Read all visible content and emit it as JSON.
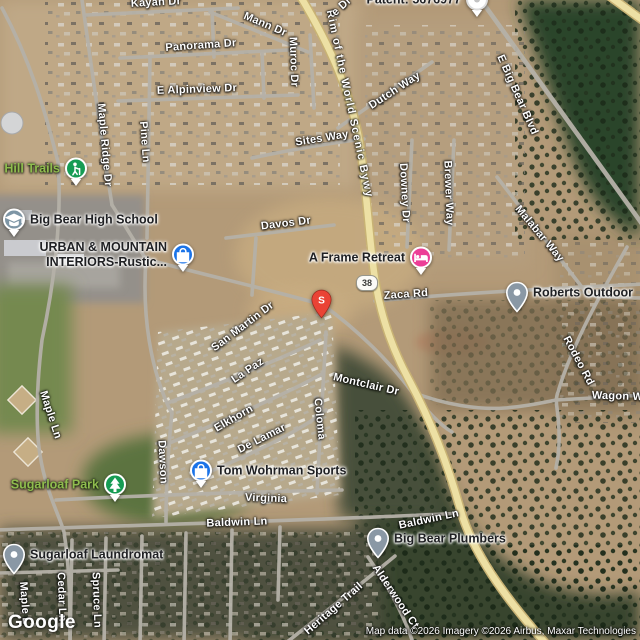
{
  "map": {
    "type": "satellite",
    "google_logo": "Google",
    "attribution": "Map data ©2026 Imagery ©2026 Airbus, Maxar Technologies",
    "route_shield": {
      "text": "38",
      "x": 366,
      "y": 282
    },
    "pin": {
      "label": "S",
      "x": 321,
      "y": 318,
      "color": "#EA4335"
    },
    "colors": {
      "shopping_blue": "#1A73E8",
      "lodging_pink": "#EC3E97",
      "park_green": "#169C54",
      "school_gray": "#7E96A6",
      "generic_pin_gray": "#8A98A5",
      "white_poi": "#FFFFFF",
      "park_label_green": "#8FBC4E",
      "highway_yellow": "#EDE0A4"
    },
    "street_labels": [
      {
        "text": "Kayan Dr",
        "x": 156,
        "y": 3,
        "r": -3
      },
      {
        "text": "Mann Dr",
        "x": 265,
        "y": 25,
        "r": 23
      },
      {
        "text": "Panorama Dr",
        "x": 201,
        "y": 46,
        "r": -4
      },
      {
        "text": "E Alpinview Dr",
        "x": 197,
        "y": 90,
        "r": -2
      },
      {
        "text": "Muroc Dr",
        "x": 293,
        "y": 62,
        "r": 88
      },
      {
        "text": "Rim of the World Scenic Bywy",
        "x": 349,
        "y": 104,
        "r": 78,
        "long": true
      },
      {
        "text": "Dutch Way",
        "x": 395,
        "y": 91,
        "r": -33
      },
      {
        "text": "Sites Way",
        "x": 322,
        "y": 139,
        "r": -9
      },
      {
        "text": "Downey Dr",
        "x": 404,
        "y": 193,
        "r": 87
      },
      {
        "text": "Brewer Way",
        "x": 448,
        "y": 193,
        "r": 88
      },
      {
        "text": "E Big Bear Blvd",
        "x": 517,
        "y": 95,
        "r": 66
      },
      {
        "text": "Malabar Way",
        "x": 539,
        "y": 234,
        "r": 50
      },
      {
        "text": "Maple Ridge Dr",
        "x": 104,
        "y": 145,
        "r": 85
      },
      {
        "text": "Pine Ln",
        "x": 144,
        "y": 142,
        "r": 86
      },
      {
        "text": "Davos Dr",
        "x": 286,
        "y": 224,
        "r": -7
      },
      {
        "text": "Zaca Rd",
        "x": 406,
        "y": 295,
        "r": -4
      },
      {
        "text": "San Martin Dr",
        "x": 243,
        "y": 327,
        "r": -37
      },
      {
        "text": "La Paz",
        "x": 248,
        "y": 371,
        "r": -34
      },
      {
        "text": "Montclair Dr",
        "x": 366,
        "y": 385,
        "r": 13
      },
      {
        "text": "Elkhorn",
        "x": 234,
        "y": 419,
        "r": -30
      },
      {
        "text": "De Lamar",
        "x": 262,
        "y": 439,
        "r": -27
      },
      {
        "text": "Coloma",
        "x": 319,
        "y": 419,
        "r": 84
      },
      {
        "text": "Dawson",
        "x": 162,
        "y": 462,
        "r": 87
      },
      {
        "text": "Maple Ln",
        "x": 50,
        "y": 415,
        "r": 72
      },
      {
        "text": "Rodeo Rd",
        "x": 578,
        "y": 361,
        "r": 62
      },
      {
        "text": "Wagon Wh",
        "x": 621,
        "y": 397,
        "r": 2
      },
      {
        "text": "Virginia",
        "x": 266,
        "y": 499,
        "r": 2
      },
      {
        "text": "Baldwin Ln",
        "x": 237,
        "y": 523,
        "r": -2
      },
      {
        "text": "Baldwin Ln",
        "x": 429,
        "y": 520,
        "r": -12
      },
      {
        "text": "Heritage Trail",
        "x": 334,
        "y": 609,
        "r": -41
      },
      {
        "text": "Alderwood Ct",
        "x": 395,
        "y": 597,
        "r": 56
      },
      {
        "text": "Maple L",
        "x": 24,
        "y": 603,
        "r": 86
      },
      {
        "text": "Cedar Ln",
        "x": 61,
        "y": 597,
        "r": 88
      },
      {
        "text": "Spruce Ln",
        "x": 96,
        "y": 600,
        "r": 88
      },
      {
        "text": "e Dr",
        "x": 342,
        "y": 7,
        "r": -42
      }
    ],
    "pois": [
      {
        "name": "Hill Trails",
        "lines": [
          "Hill Trails"
        ],
        "icon": "hiking",
        "shape": "circle",
        "color": "#169C54",
        "cx": 76,
        "cy": 168,
        "side": "left",
        "label_class": "green"
      },
      {
        "name": "Big Bear High School",
        "lines": [
          "Big Bear High School"
        ],
        "icon": "school",
        "shape": "circle",
        "color": "#7E96A6",
        "cx": 14,
        "cy": 219,
        "side": "right",
        "label_class": ""
      },
      {
        "name": "URBAN & MOUNTAIN INTERIORS-Rustic...",
        "lines": [
          "URBAN & MOUNTAIN",
          "INTERIORS-Rustic..."
        ],
        "icon": "shopping",
        "shape": "circle",
        "color": "#1A73E8",
        "cx": 183,
        "cy": 254,
        "side": "left",
        "label_class": ""
      },
      {
        "name": "A Frame Retreat",
        "lines": [
          "A Frame Retreat"
        ],
        "icon": "lodging",
        "shape": "circle",
        "color": "#EC3E97",
        "cx": 421,
        "cy": 257,
        "side": "left",
        "label_class": ""
      },
      {
        "name": "Roberts Outdoor",
        "lines": [
          "Roberts Outdoor"
        ],
        "icon": "place",
        "shape": "pin",
        "color": "#8A98A5",
        "cx": 517,
        "cy": 311,
        "side": "right",
        "label_class": ""
      },
      {
        "name": "Tom Wohrman Sports",
        "lines": [
          "Tom Wohrman Sports"
        ],
        "icon": "shopping",
        "shape": "circle",
        "color": "#1A73E8",
        "cx": 201,
        "cy": 470,
        "side": "right",
        "label_class": ""
      },
      {
        "name": "Sugarloaf Park",
        "lines": [
          "Sugarloaf Park"
        ],
        "icon": "park",
        "shape": "circle",
        "color": "#169C54",
        "cx": 115,
        "cy": 484,
        "side": "left",
        "label_class": "green"
      },
      {
        "name": "Big Bear Plumbers",
        "lines": [
          "Big Bear Plumbers"
        ],
        "icon": "place",
        "shape": "pin",
        "color": "#8A98A5",
        "cx": 378,
        "cy": 557,
        "side": "right",
        "label_class": ""
      },
      {
        "name": "Sugarloaf Laundromat",
        "lines": [
          "Sugarloaf Laundromat"
        ],
        "icon": "place",
        "shape": "pin",
        "color": "#8A98A5",
        "cx": 14,
        "cy": 573,
        "side": "right",
        "label_class": ""
      },
      {
        "name": "Patent: 5676977",
        "lines": [
          "Patent: 5676977"
        ],
        "icon": "place-white",
        "shape": "circle",
        "color": "#FFFFFF",
        "cx": 477,
        "cy": -1,
        "side": "left",
        "label_class": ""
      }
    ]
  }
}
